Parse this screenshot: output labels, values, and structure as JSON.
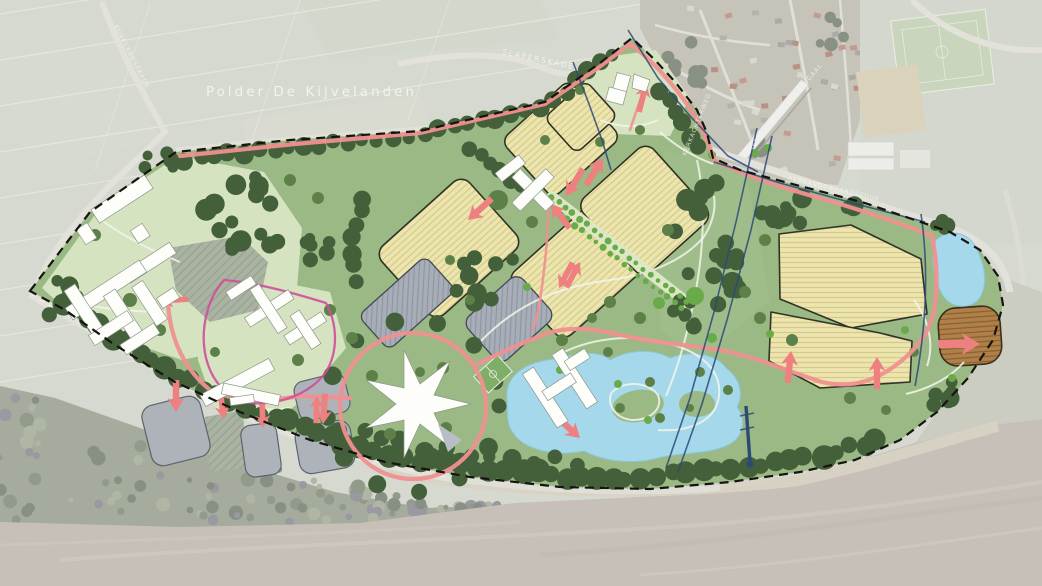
{
  "map": {
    "area_label": "Polder De Kijvelanden",
    "roads": {
      "north_road": "SLAPERSKADE",
      "west_road": "KIJVELANDSEKADE",
      "dike_road": "ALBRANDSWAARDSEDIJK",
      "village_road": "KERKACHTERWEG",
      "station": "METROSTATION POORTUGAAL"
    }
  },
  "colors": {
    "aerial_field": "#c7ccc0",
    "site_green": "#9bb985",
    "lawn_green": "#d5e3c1",
    "tree_dark": "#43603a",
    "tree_mid": "#5d8049",
    "tree_bright": "#69ab4b",
    "parcel_yellow": "#ece5ad",
    "parcel_hatch": "#d5ca8c",
    "parcel_outline": "#2f3327",
    "parcel_brown": "#b08049",
    "brown_hatch": "#8a5e30",
    "water_blue": "#a5d8ea",
    "path_pink": "#f09090",
    "arrow_pink": "#ee8080",
    "loop_magenta": "#cf4f9b",
    "power_blue": "#2c4a78",
    "parking_gray": "#aeb3ba",
    "block_gray": "#a8aeb7",
    "boundary_black": "#15150f",
    "village_tan": "#b2aea1",
    "roof_red": "#a06a5a",
    "river_tan": "#b4aaa0",
    "forest_gray": "#868f7b",
    "road_light": "#d8d8cf",
    "building_white": "#fdfdfa",
    "label_white": "#f4f5f0"
  }
}
